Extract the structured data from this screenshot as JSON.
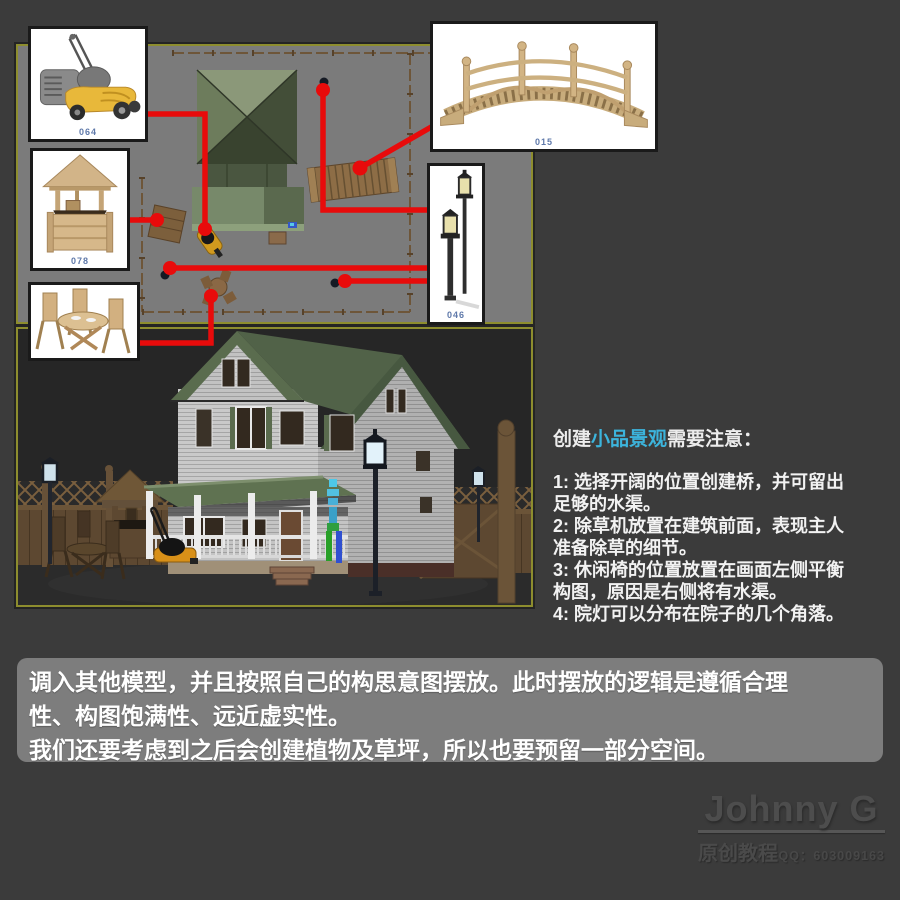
{
  "colors": {
    "accent_red": "#e80b0b",
    "highlight_cyan": "#3cb4dc",
    "viewport_border_yellow": "#8d8d2e",
    "viewport_gray": "#7b7b7b",
    "render_background": "#262626"
  },
  "thumbnails": {
    "mower": {
      "label": "064",
      "name": "lawn-mower"
    },
    "well": {
      "label": "078",
      "name": "wishing-well"
    },
    "table": {
      "label": "",
      "name": "patio-table-set"
    },
    "bridge": {
      "label": "015",
      "name": "wooden-bridge"
    },
    "lamp": {
      "label": "046",
      "name": "garden-lamps"
    }
  },
  "notes": {
    "heading_prefix": "创建",
    "heading_highlight": "小品景观",
    "heading_suffix": "需要注意：",
    "items": [
      "1: 选择开阔的位置创建桥，并可留出足够的水渠。",
      "2: 除草机放置在建筑前面，表现主人准备除草的细节。",
      "3: 休闲椅的位置放置在画面左侧平衡构图，原因是右侧将有水渠。",
      "4: 院灯可以分布在院子的几个角落。"
    ]
  },
  "bottom_panel": {
    "line1": "调入其他模型，并且按照自己的构思意图摆放。此时摆放的逻辑是遵循合理性、构图饱满性、远近虚实性。",
    "line2": "我们还要考虑到之后会创建植物及草坪，所以也要预留一部分空间。"
  },
  "watermark": {
    "name": "Johnny G",
    "tagline": "原创教程",
    "qq": "QQ：603009163"
  }
}
